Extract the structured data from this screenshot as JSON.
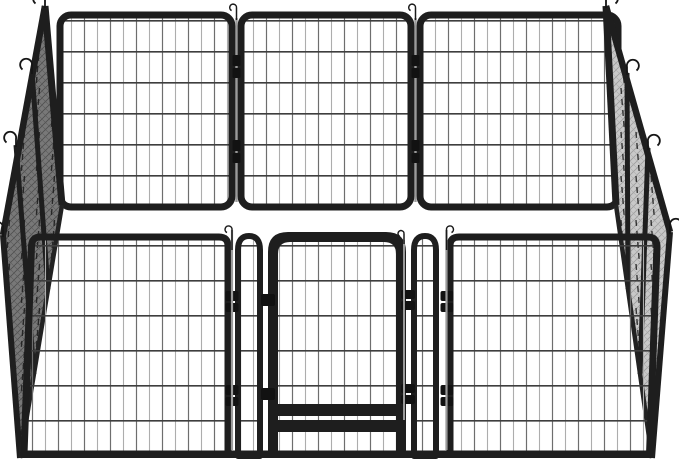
{
  "scene": {
    "type": "product-photo",
    "background_color": "#ffffff",
    "aria_label": "Heavy-duty black metal dog playpen: rectangular enclosure of wire-mesh panels with a walk-through gate in the front wall and wire anchor hooks on the corner posts",
    "subject": "metal pet playpen with gate"
  },
  "colors": {
    "frame": "#1e1e1e",
    "clamp": "#121212",
    "rod": "#9a9a9a",
    "wire_vertical_dark": "#6e6e6e",
    "wire_vertical_light": "#adadad",
    "wire_horizontal": "#3e3e3e",
    "left_wall_base": "#787878",
    "left_wall_hatch": "#4e4e4e",
    "right_wall_base": "#c9c9c9",
    "right_wall_hatch": "#9c9c9c",
    "dash_line": "#1a1a1a"
  },
  "structure": {
    "back_wall_panels": 3,
    "left_wall_panels": 3,
    "right_wall_panels": 3,
    "front_wall": {
      "wide_panels": 2,
      "narrow_sections": 2,
      "gate": {
        "doors": 1,
        "hinges": 2,
        "latch_rods": 1
      }
    },
    "anchor_hooks": 8,
    "connector_pins": 4
  }
}
